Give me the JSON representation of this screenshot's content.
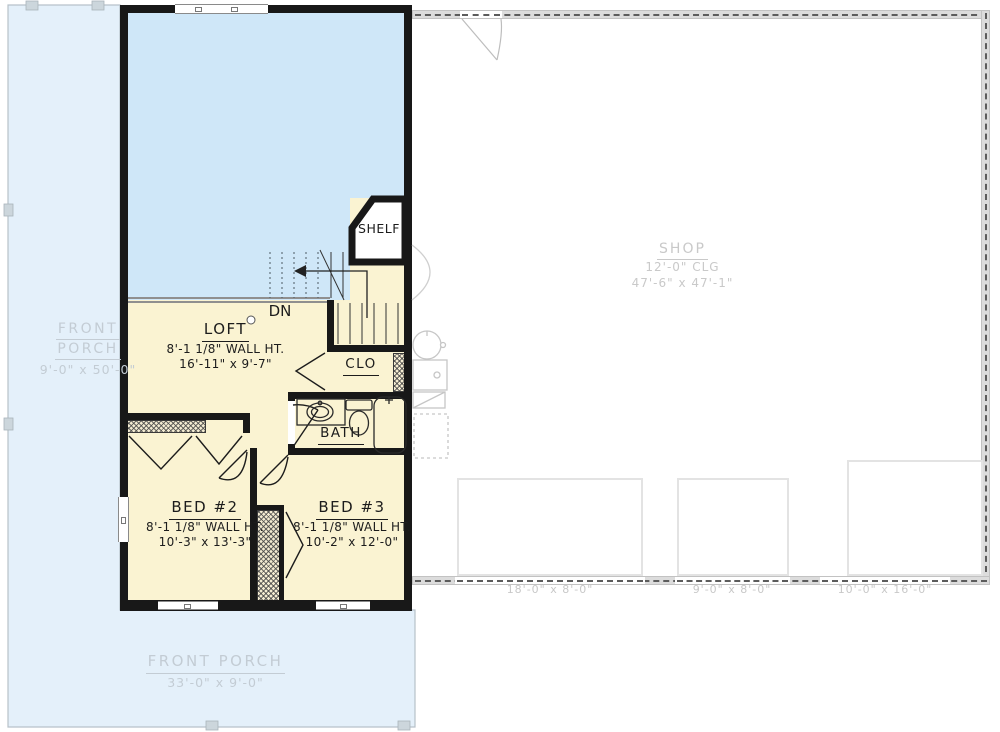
{
  "colors": {
    "porch_fill": "#e4f0fa",
    "open_area_fill": "#cfe7f8",
    "room_fill": "#faf3d2",
    "wall": "#181818",
    "shop_wall": "#dcdcdc",
    "gray_text": "#c9c9c9",
    "porch_text": "#c3ccd4"
  },
  "porch_left": {
    "line1": "FRONT",
    "line2": "PORCH",
    "dims": "9'-0\" x 50'-0\""
  },
  "porch_bottom": {
    "name": "FRONT PORCH",
    "dims": "33'-0\" x 9'-0\""
  },
  "loft": {
    "name": "LOFT",
    "wall_ht": "8'-1 1/8\" WALL HT.",
    "dims": "16'-11\" x 9'-7\""
  },
  "shelf": {
    "name": "SHELF"
  },
  "stairs": {
    "label": "DN"
  },
  "clo": {
    "name": "CLO"
  },
  "bath": {
    "name": "BATH"
  },
  "bed2": {
    "name": "BED #2",
    "wall_ht": "8'-1 1/8\" WALL HT.",
    "dims": "10'-3\" x 13'-3\""
  },
  "bed3": {
    "name": "BED #3",
    "wall_ht": "8'-1 1/8\" WALL HT.",
    "dims": "10'-2\" x 12'-0\""
  },
  "shop": {
    "name": "SHOP",
    "ceiling": "12'-0\" CLG",
    "dims": "47'-6\" x 47'-1\""
  },
  "shop_doors": [
    {
      "dims": "18'-0\" x 8'-0\""
    },
    {
      "dims": "9'-0\" x 8'-0\""
    },
    {
      "dims": "10'-0\" x 16'-0\""
    }
  ]
}
